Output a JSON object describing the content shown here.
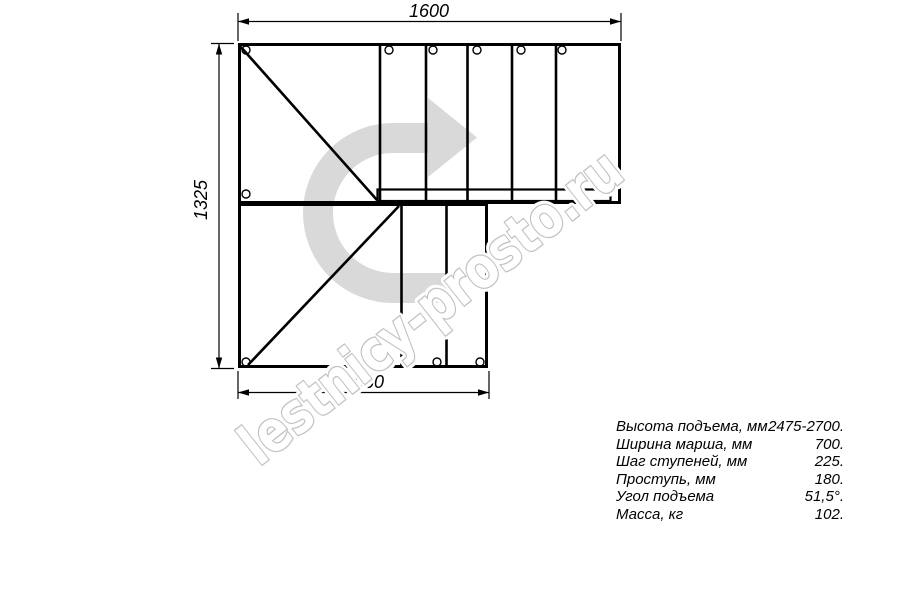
{
  "watermark": {
    "text": "lestnicy-prosto.ru",
    "arrow_color": "#d9d9d9",
    "outline_color": "#c2c2c2"
  },
  "dimensions": {
    "top_width": "1600",
    "left_height": "1325",
    "bottom_width": "1060"
  },
  "specs": {
    "rows": [
      {
        "label": "Высота подъема, мм",
        "value": "2475-2700."
      },
      {
        "label": "Ширина марша, мм",
        "value": "700."
      },
      {
        "label": "Шаг ступеней, мм",
        "value": "225."
      },
      {
        "label": "Проступь, мм",
        "value": "180."
      },
      {
        "label": "Угол подъема",
        "value": "51,5°."
      },
      {
        "label": "Масса, кг",
        "value": "102."
      }
    ]
  }
}
